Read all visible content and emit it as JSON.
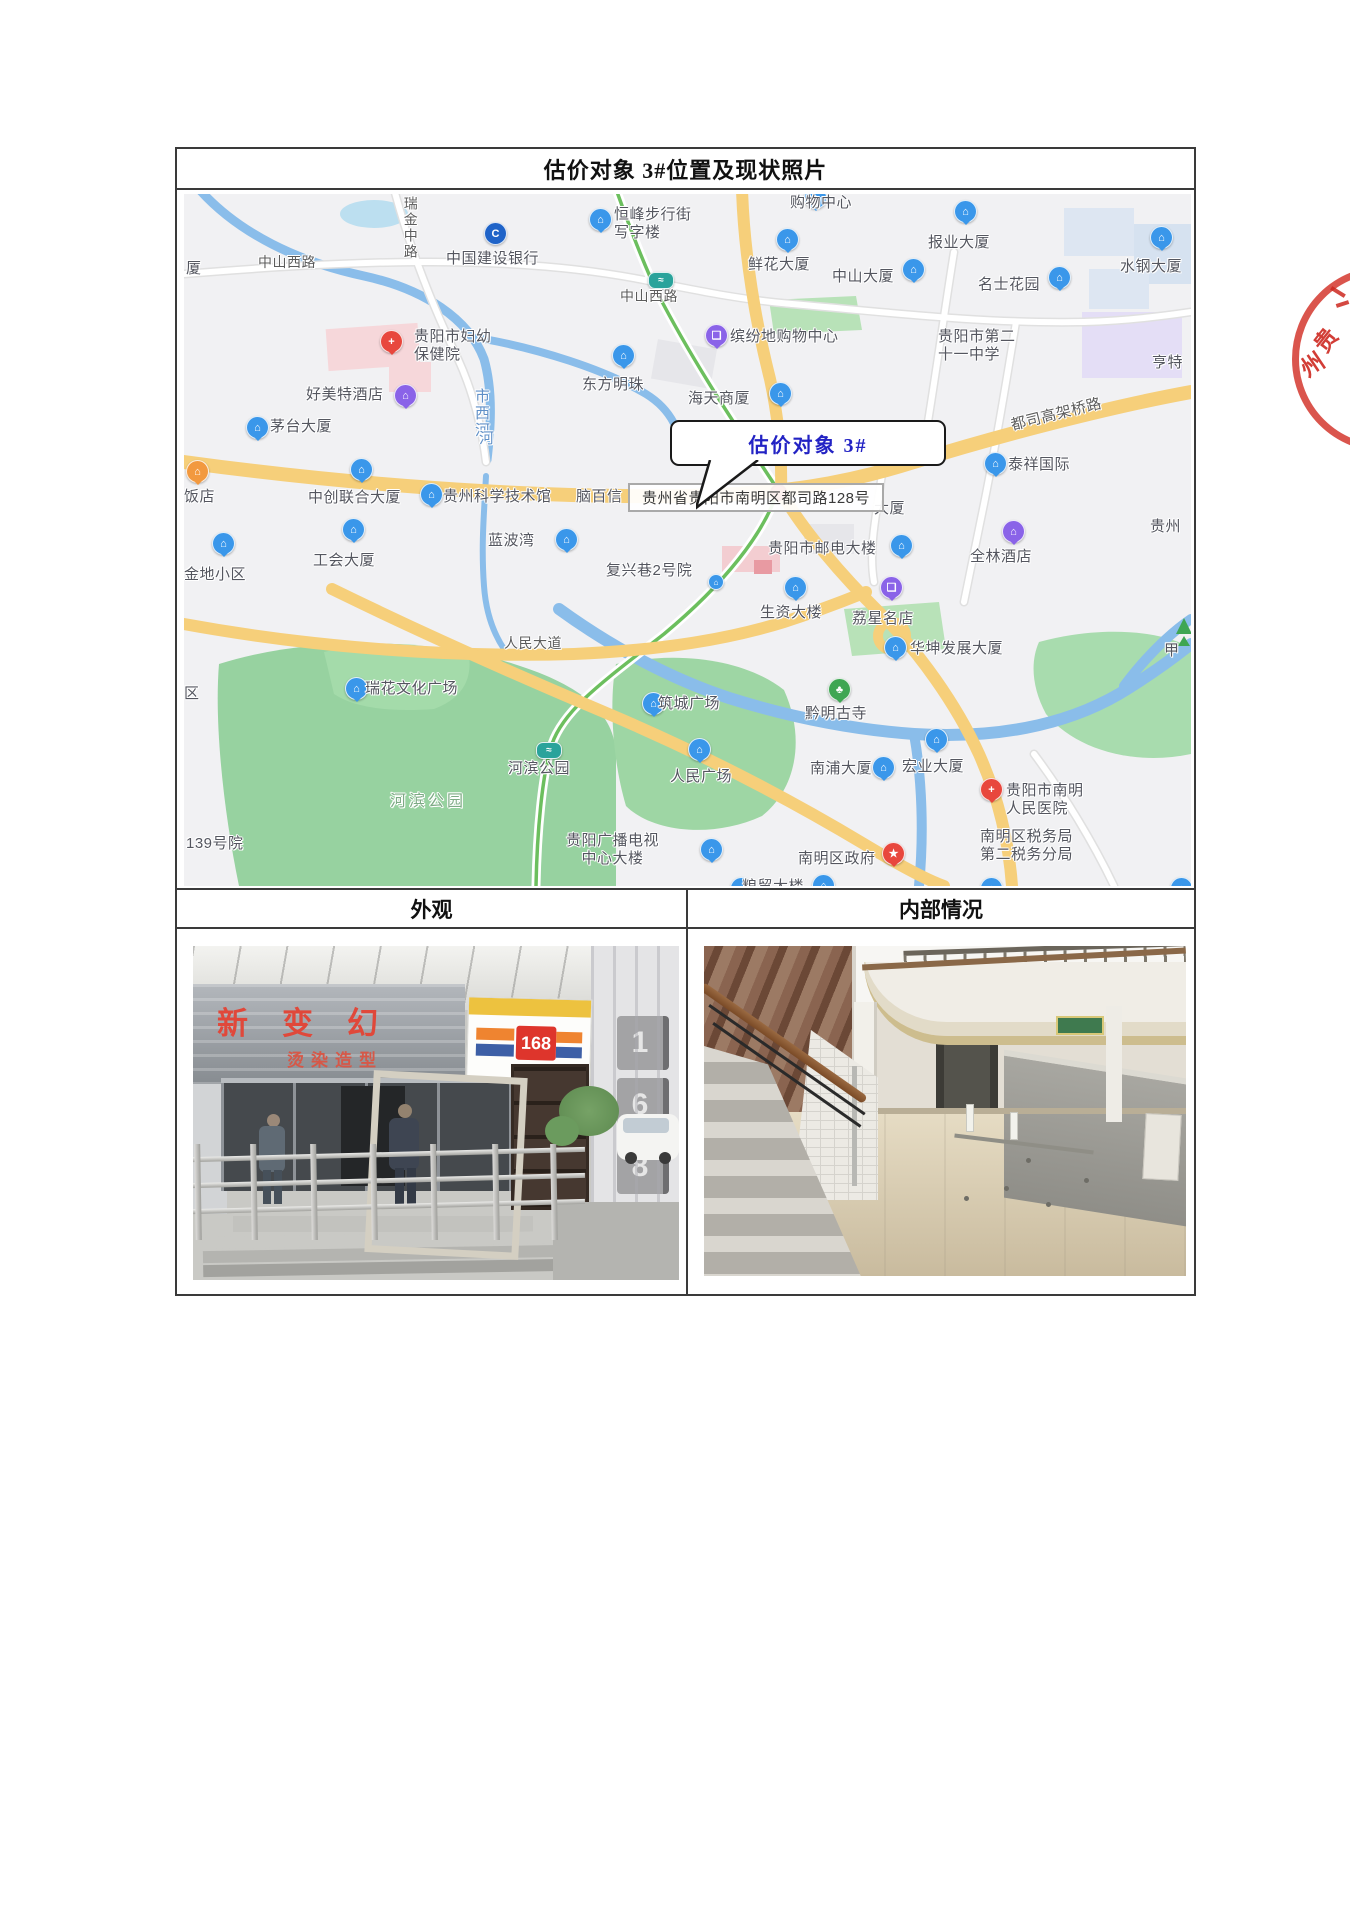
{
  "document": {
    "title": "估价对象 3#位置及现状照片",
    "exterior_header": "外观",
    "interior_header": "内部情况"
  },
  "map": {
    "callout_label": "估价对象 3#",
    "address_tooltip": "贵州省贵阳市南明区都司路128号",
    "pin_colors": {
      "blue": "#3a97ea",
      "purple": "#8a63e8",
      "red": "#e8473d",
      "green": "#3fa653",
      "teal": "#2aa39b",
      "orange": "#f2993f",
      "navy": "#1f63c8"
    },
    "labels": [
      {
        "text": "厦",
        "x": 2,
        "y": 66
      },
      {
        "text": "中山西路",
        "x": 74,
        "y": 60,
        "kind": "road"
      },
      {
        "text": "瑞金中路",
        "x": 218,
        "y": 2,
        "kind": "road",
        "vertical": true
      },
      {
        "text": "中国建设银行",
        "x": 262,
        "y": 56
      },
      {
        "lines": [
          "恒峰步行街",
          "写字楼"
        ],
        "x": 430,
        "y": 12
      },
      {
        "text": "购物中心",
        "x": 606,
        "y": 0
      },
      {
        "text": "鲜花大厦",
        "x": 564,
        "y": 62
      },
      {
        "text": "中山大厦",
        "x": 648,
        "y": 74
      },
      {
        "text": "报业大厦",
        "x": 744,
        "y": 40
      },
      {
        "text": "名士花园",
        "x": 794,
        "y": 82
      },
      {
        "text": "水钢大厦",
        "x": 936,
        "y": 64
      },
      {
        "text": "中山西路",
        "x": 436,
        "y": 94,
        "kind": "road"
      },
      {
        "text": "缤纷地购物中心",
        "x": 546,
        "y": 134
      },
      {
        "lines": [
          "贵阳市第二",
          "十一中学"
        ],
        "x": 754,
        "y": 134
      },
      {
        "text": "亨特",
        "x": 968,
        "y": 160
      },
      {
        "lines": [
          "贵阳市妇幼",
          "保健院"
        ],
        "x": 230,
        "y": 134
      },
      {
        "text": "好美特酒店",
        "x": 122,
        "y": 192
      },
      {
        "text": "东方明珠",
        "x": 398,
        "y": 182
      },
      {
        "text": "海天商厦",
        "x": 504,
        "y": 196
      },
      {
        "text": "市西河",
        "x": 288,
        "y": 194,
        "kind": "river",
        "vertical": true
      },
      {
        "text": "河",
        "x": 292,
        "y": 236,
        "kind": "river",
        "vertical": true
      },
      {
        "text": "茅台大厦",
        "x": 86,
        "y": 224
      },
      {
        "text": "都司高架桥路",
        "x": 826,
        "y": 212,
        "kind": "road",
        "rotate": -14,
        "size": 15
      },
      {
        "text": "泰祥国际",
        "x": 824,
        "y": 262
      },
      {
        "text": "饭店",
        "x": 0,
        "y": 294
      },
      {
        "text": "中创联合大厦",
        "x": 124,
        "y": 295
      },
      {
        "text": "贵州科学技术馆",
        "x": 259,
        "y": 294
      },
      {
        "text": "脑百信",
        "x": 392,
        "y": 294
      },
      {
        "text": "大厦",
        "x": 690,
        "y": 306
      },
      {
        "text": "贵州",
        "x": 966,
        "y": 324
      },
      {
        "text": "蓝波湾",
        "x": 304,
        "y": 338
      },
      {
        "text": "工会大厦",
        "x": 129,
        "y": 358
      },
      {
        "text": "金地小区",
        "x": 0,
        "y": 372
      },
      {
        "text": "复兴巷2号院",
        "x": 422,
        "y": 368
      },
      {
        "text": "贵阳市邮电大楼",
        "x": 584,
        "y": 346
      },
      {
        "text": "全林酒店",
        "x": 786,
        "y": 354
      },
      {
        "text": "生资大楼",
        "x": 576,
        "y": 410
      },
      {
        "text": "荔星名店",
        "x": 668,
        "y": 416
      },
      {
        "text": "华坤发展大厦",
        "x": 726,
        "y": 446
      },
      {
        "text": "甲",
        "x": 980,
        "y": 448
      },
      {
        "text": "人民大道",
        "x": 320,
        "y": 441,
        "kind": "road"
      },
      {
        "text": "瑞花文化广场",
        "x": 181,
        "y": 486
      },
      {
        "text": "区",
        "x": 0,
        "y": 491
      },
      {
        "text": "筑城广场",
        "x": 474,
        "y": 501
      },
      {
        "text": "黔明古寺",
        "x": 621,
        "y": 511
      },
      {
        "text": "河滨公园",
        "x": 324,
        "y": 566
      },
      {
        "text": "河滨公园",
        "x": 206,
        "y": 598,
        "kind": "park"
      },
      {
        "text": "人民广场",
        "x": 486,
        "y": 574
      },
      {
        "text": "南浦大厦",
        "x": 626,
        "y": 566
      },
      {
        "text": "宏业大厦",
        "x": 718,
        "y": 564
      },
      {
        "lines": [
          "贵阳市南明",
          "人民医院"
        ],
        "x": 822,
        "y": 588
      },
      {
        "text": "139号院",
        "x": 2,
        "y": 641
      },
      {
        "lines": [
          "贵阳广播电视",
          "中心大楼"
        ],
        "x": 382,
        "y": 638,
        "center": true
      },
      {
        "text": "南明区政府",
        "x": 614,
        "y": 656
      },
      {
        "lines": [
          "南明区税务局",
          "第二税务分局"
        ],
        "x": 796,
        "y": 634
      },
      {
        "text": "粮贸大楼",
        "x": 558,
        "y": 684
      }
    ],
    "pins": [
      {
        "x": 300,
        "y": 28,
        "c": "navy",
        "g": "C",
        "shape": "circle"
      },
      {
        "x": 620,
        "y": -8,
        "c": "blue",
        "g": "⌂"
      },
      {
        "x": 405,
        "y": 14,
        "c": "blue",
        "g": "⌂"
      },
      {
        "x": 592,
        "y": 34,
        "c": "blue",
        "g": "⌂"
      },
      {
        "x": 718,
        "y": 64,
        "c": "blue",
        "g": "⌂"
      },
      {
        "x": 770,
        "y": 6,
        "c": "blue",
        "g": "⌂"
      },
      {
        "x": 966,
        "y": 32,
        "c": "blue",
        "g": "⌂"
      },
      {
        "x": 864,
        "y": 72,
        "c": "blue",
        "g": "⌂"
      },
      {
        "x": 464,
        "y": 78,
        "c": "teal",
        "g": "≈",
        "shape": "circle",
        "cls": "metro"
      },
      {
        "x": 521,
        "y": 130,
        "c": "purple",
        "g": "❑"
      },
      {
        "x": 196,
        "y": 136,
        "c": "red",
        "g": "+"
      },
      {
        "x": 210,
        "y": 190,
        "c": "purple",
        "g": "⌂"
      },
      {
        "x": 428,
        "y": 150,
        "c": "blue",
        "g": "⌂"
      },
      {
        "x": 585,
        "y": 188,
        "c": "blue",
        "g": "⌂"
      },
      {
        "x": 62,
        "y": 222,
        "c": "blue",
        "g": "⌂"
      },
      {
        "x": 800,
        "y": 258,
        "c": "blue",
        "g": "⌂"
      },
      {
        "x": 2,
        "y": 266,
        "c": "orange",
        "g": "⌂"
      },
      {
        "x": 166,
        "y": 264,
        "c": "blue",
        "g": "⌂"
      },
      {
        "x": 236,
        "y": 289,
        "c": "blue",
        "g": "⌂"
      },
      {
        "x": 371,
        "y": 334,
        "c": "blue",
        "g": "⌂"
      },
      {
        "x": 158,
        "y": 324,
        "c": "blue",
        "g": "⌂"
      },
      {
        "x": 28,
        "y": 338,
        "c": "blue",
        "g": "⌂"
      },
      {
        "x": 524,
        "y": 380,
        "c": "blue",
        "g": "⌂",
        "shape": "circle",
        "small": true
      },
      {
        "x": 706,
        "y": 340,
        "c": "blue",
        "g": "⌂"
      },
      {
        "x": 818,
        "y": 326,
        "c": "purple",
        "g": "⌂"
      },
      {
        "x": 600,
        "y": 382,
        "c": "blue",
        "g": "⌂"
      },
      {
        "x": 696,
        "y": 382,
        "c": "purple",
        "g": "❑"
      },
      {
        "x": 700,
        "y": 442,
        "c": "blue",
        "g": "⌂"
      },
      {
        "x": 161,
        "y": 483,
        "c": "blue",
        "g": "⌂"
      },
      {
        "x": 458,
        "y": 498,
        "c": "blue",
        "g": "⌂"
      },
      {
        "x": 644,
        "y": 484,
        "c": "green",
        "g": "♣"
      },
      {
        "x": 352,
        "y": 548,
        "c": "teal",
        "g": "≈",
        "shape": "circle",
        "cls": "metro"
      },
      {
        "x": 504,
        "y": 544,
        "c": "blue",
        "g": "⌂"
      },
      {
        "x": 688,
        "y": 562,
        "c": "blue",
        "g": "⌂"
      },
      {
        "x": 741,
        "y": 534,
        "c": "blue",
        "g": "⌂"
      },
      {
        "x": 796,
        "y": 584,
        "c": "red",
        "g": "+"
      },
      {
        "x": 516,
        "y": 644,
        "c": "blue",
        "g": "⌂"
      },
      {
        "x": 698,
        "y": 648,
        "c": "red",
        "g": "★"
      },
      {
        "x": 628,
        "y": 680,
        "c": "blue",
        "g": "⌂"
      },
      {
        "x": 546,
        "y": 683,
        "c": "blue",
        "g": "⌂"
      },
      {
        "x": 796,
        "y": 683,
        "c": "blue",
        "g": "⌂"
      },
      {
        "x": 986,
        "y": 683,
        "c": "blue",
        "g": "⌂"
      }
    ]
  },
  "photos": {
    "exterior": {
      "awning_text": "新变幻",
      "awning_subtext": "烫染造型",
      "storefront_number": "168",
      "side_sign": "168"
    },
    "interior": {}
  },
  "stamp": {
    "char_top": "贵",
    "char_bottom": "州"
  },
  "colors": {
    "road_yellow": "#f6cf7a",
    "green_road": "#6cbf5e",
    "water": "#8abdea",
    "park_green": "#9ed6a4",
    "stamp_red": "#d4372e",
    "callout_text": "#2323c4",
    "sign_red": "#de352c",
    "sign_yellow": "#edc23f"
  }
}
